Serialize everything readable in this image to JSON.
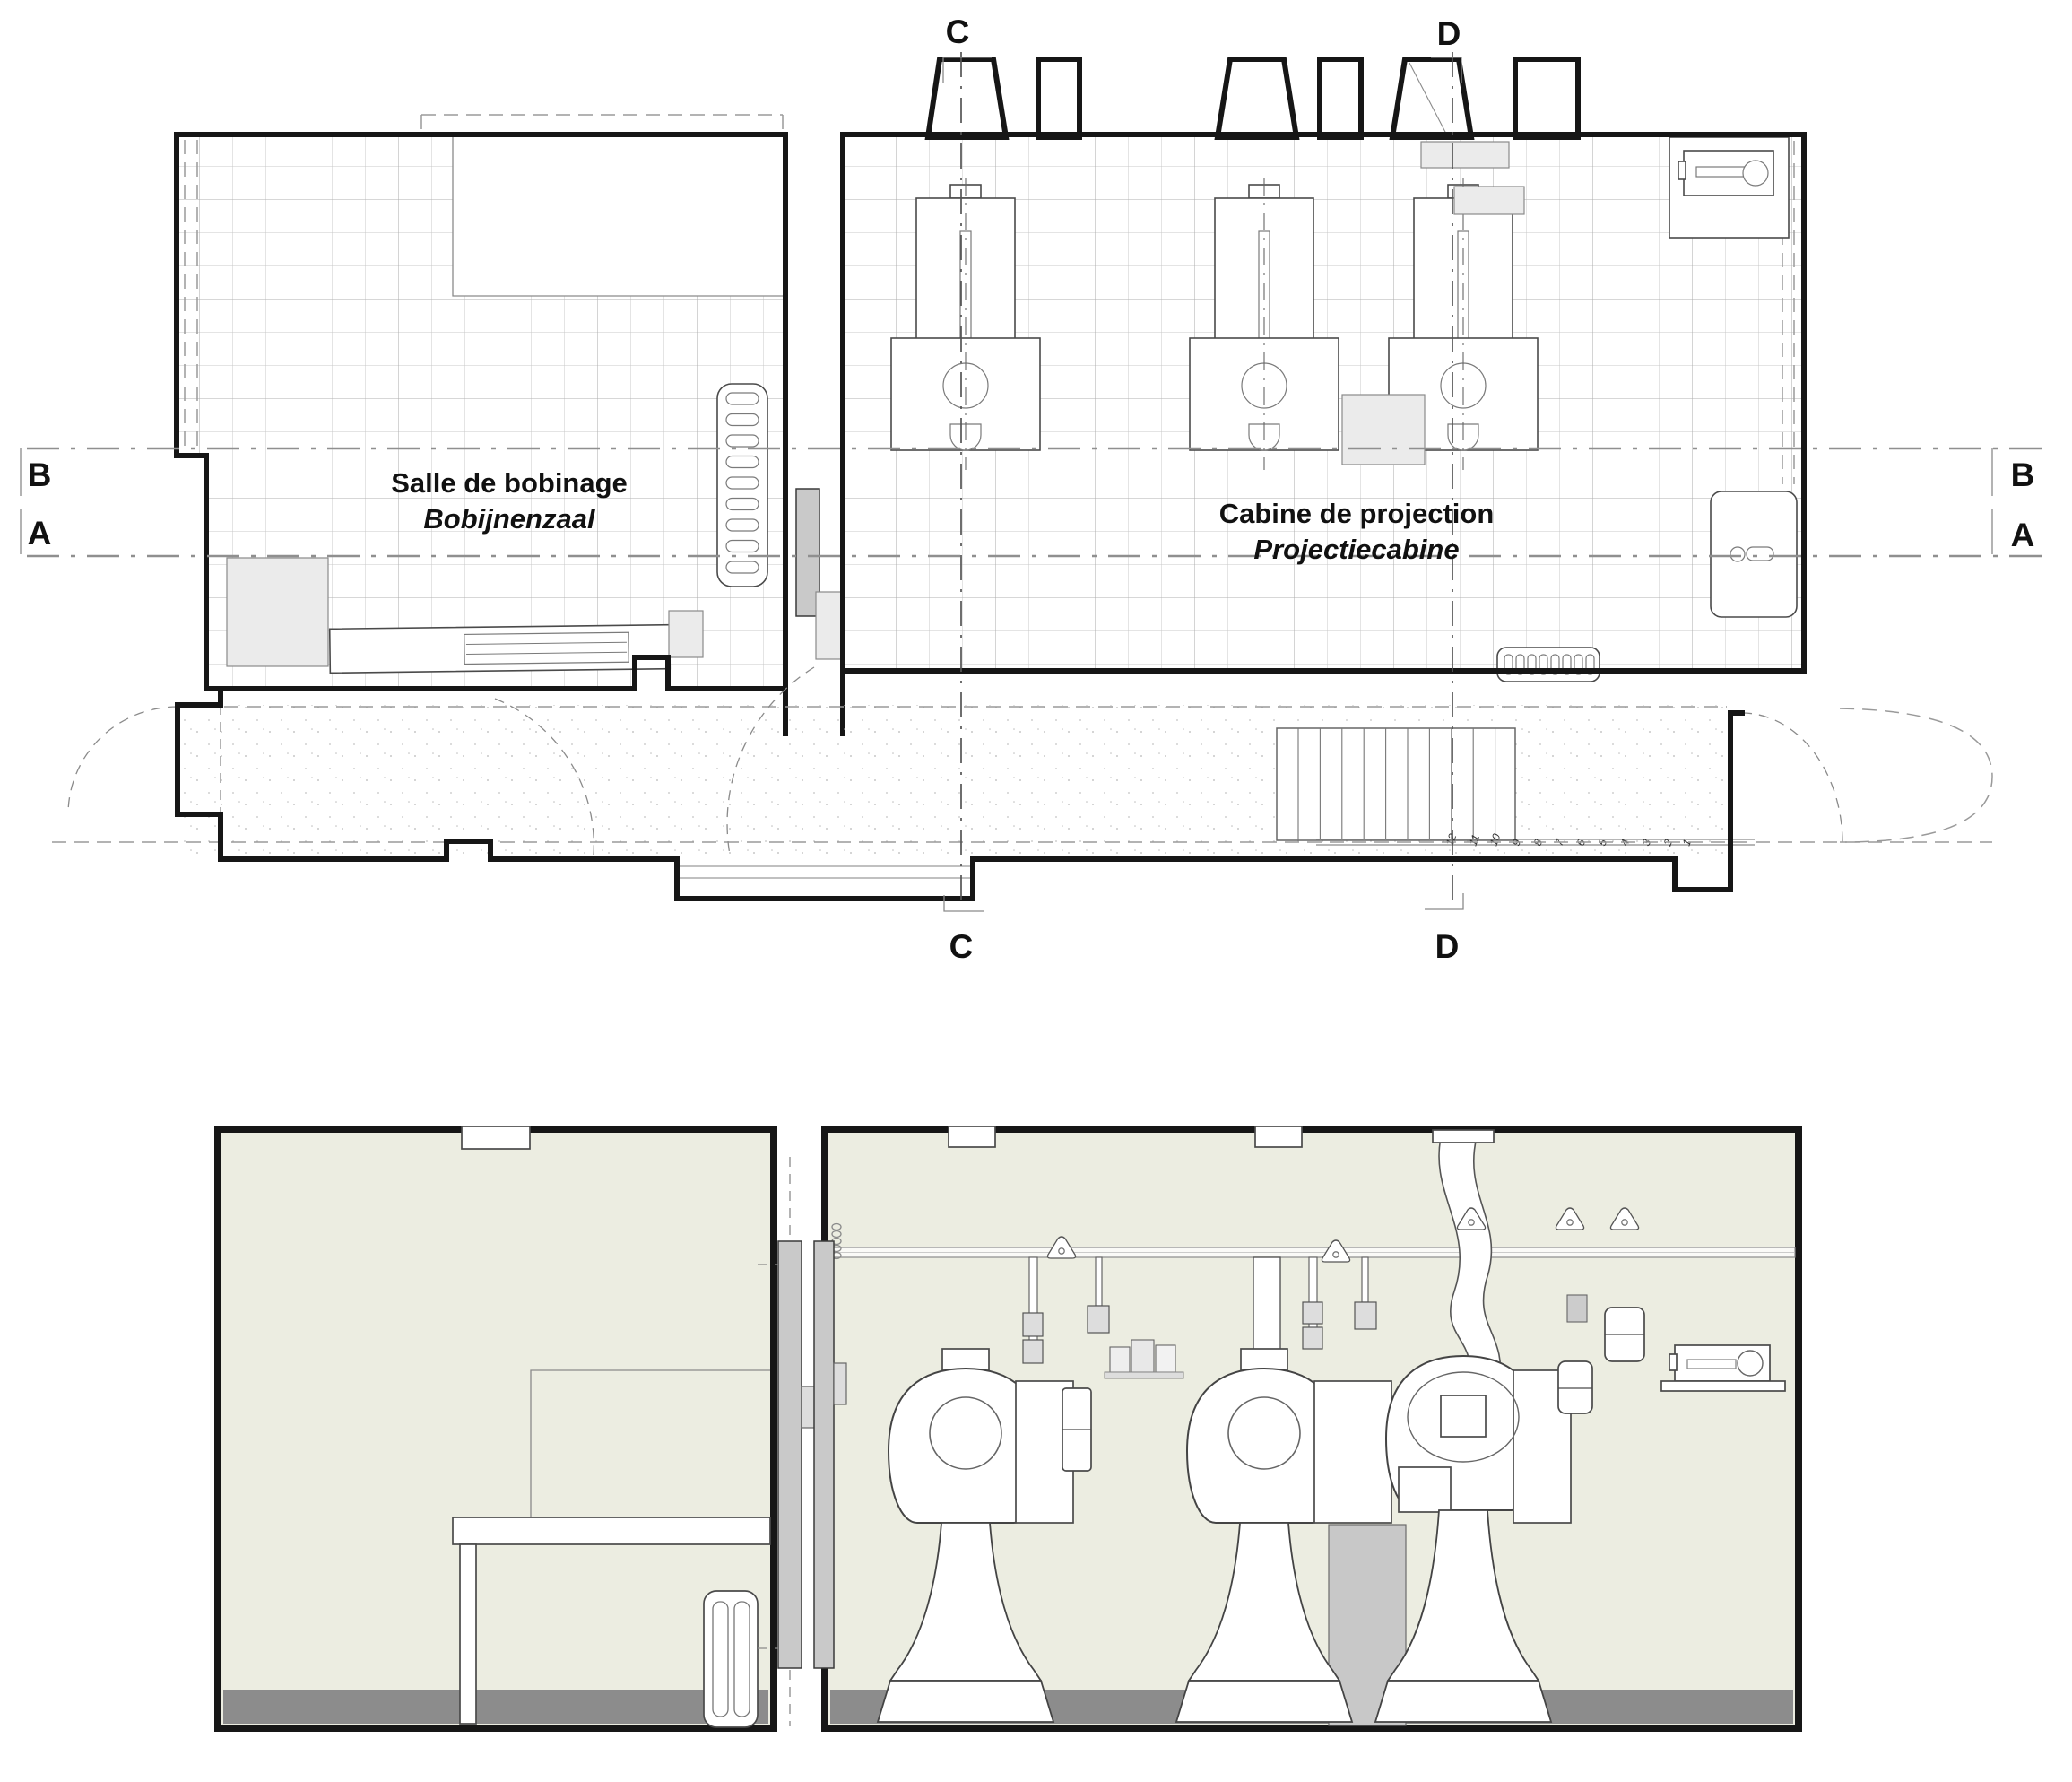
{
  "colors": {
    "ink": "#161616",
    "room_fill": "#ECEDE1",
    "floor_strip": "#8C8C8C",
    "door_gray": "#C9C9C9",
    "furniture_gray": "#EBEBEB",
    "cabinet_gray": "#C8C8C8",
    "dash_gray": "#8F8F8F"
  },
  "plan": {
    "room_left": {
      "name_fr": "Salle de bobinage",
      "name_nl": "Bobijnenzaal"
    },
    "room_right": {
      "name_fr": "Cabine de projection",
      "name_nl": "Projectiecabine"
    },
    "markers": {
      "a": "A",
      "b": "B",
      "c": "C",
      "d": "D"
    },
    "stairs": {
      "numbers": [
        "12",
        "11",
        "10",
        "9",
        "8",
        "7",
        "6",
        "5",
        "4",
        "3",
        "2",
        "1"
      ]
    }
  }
}
